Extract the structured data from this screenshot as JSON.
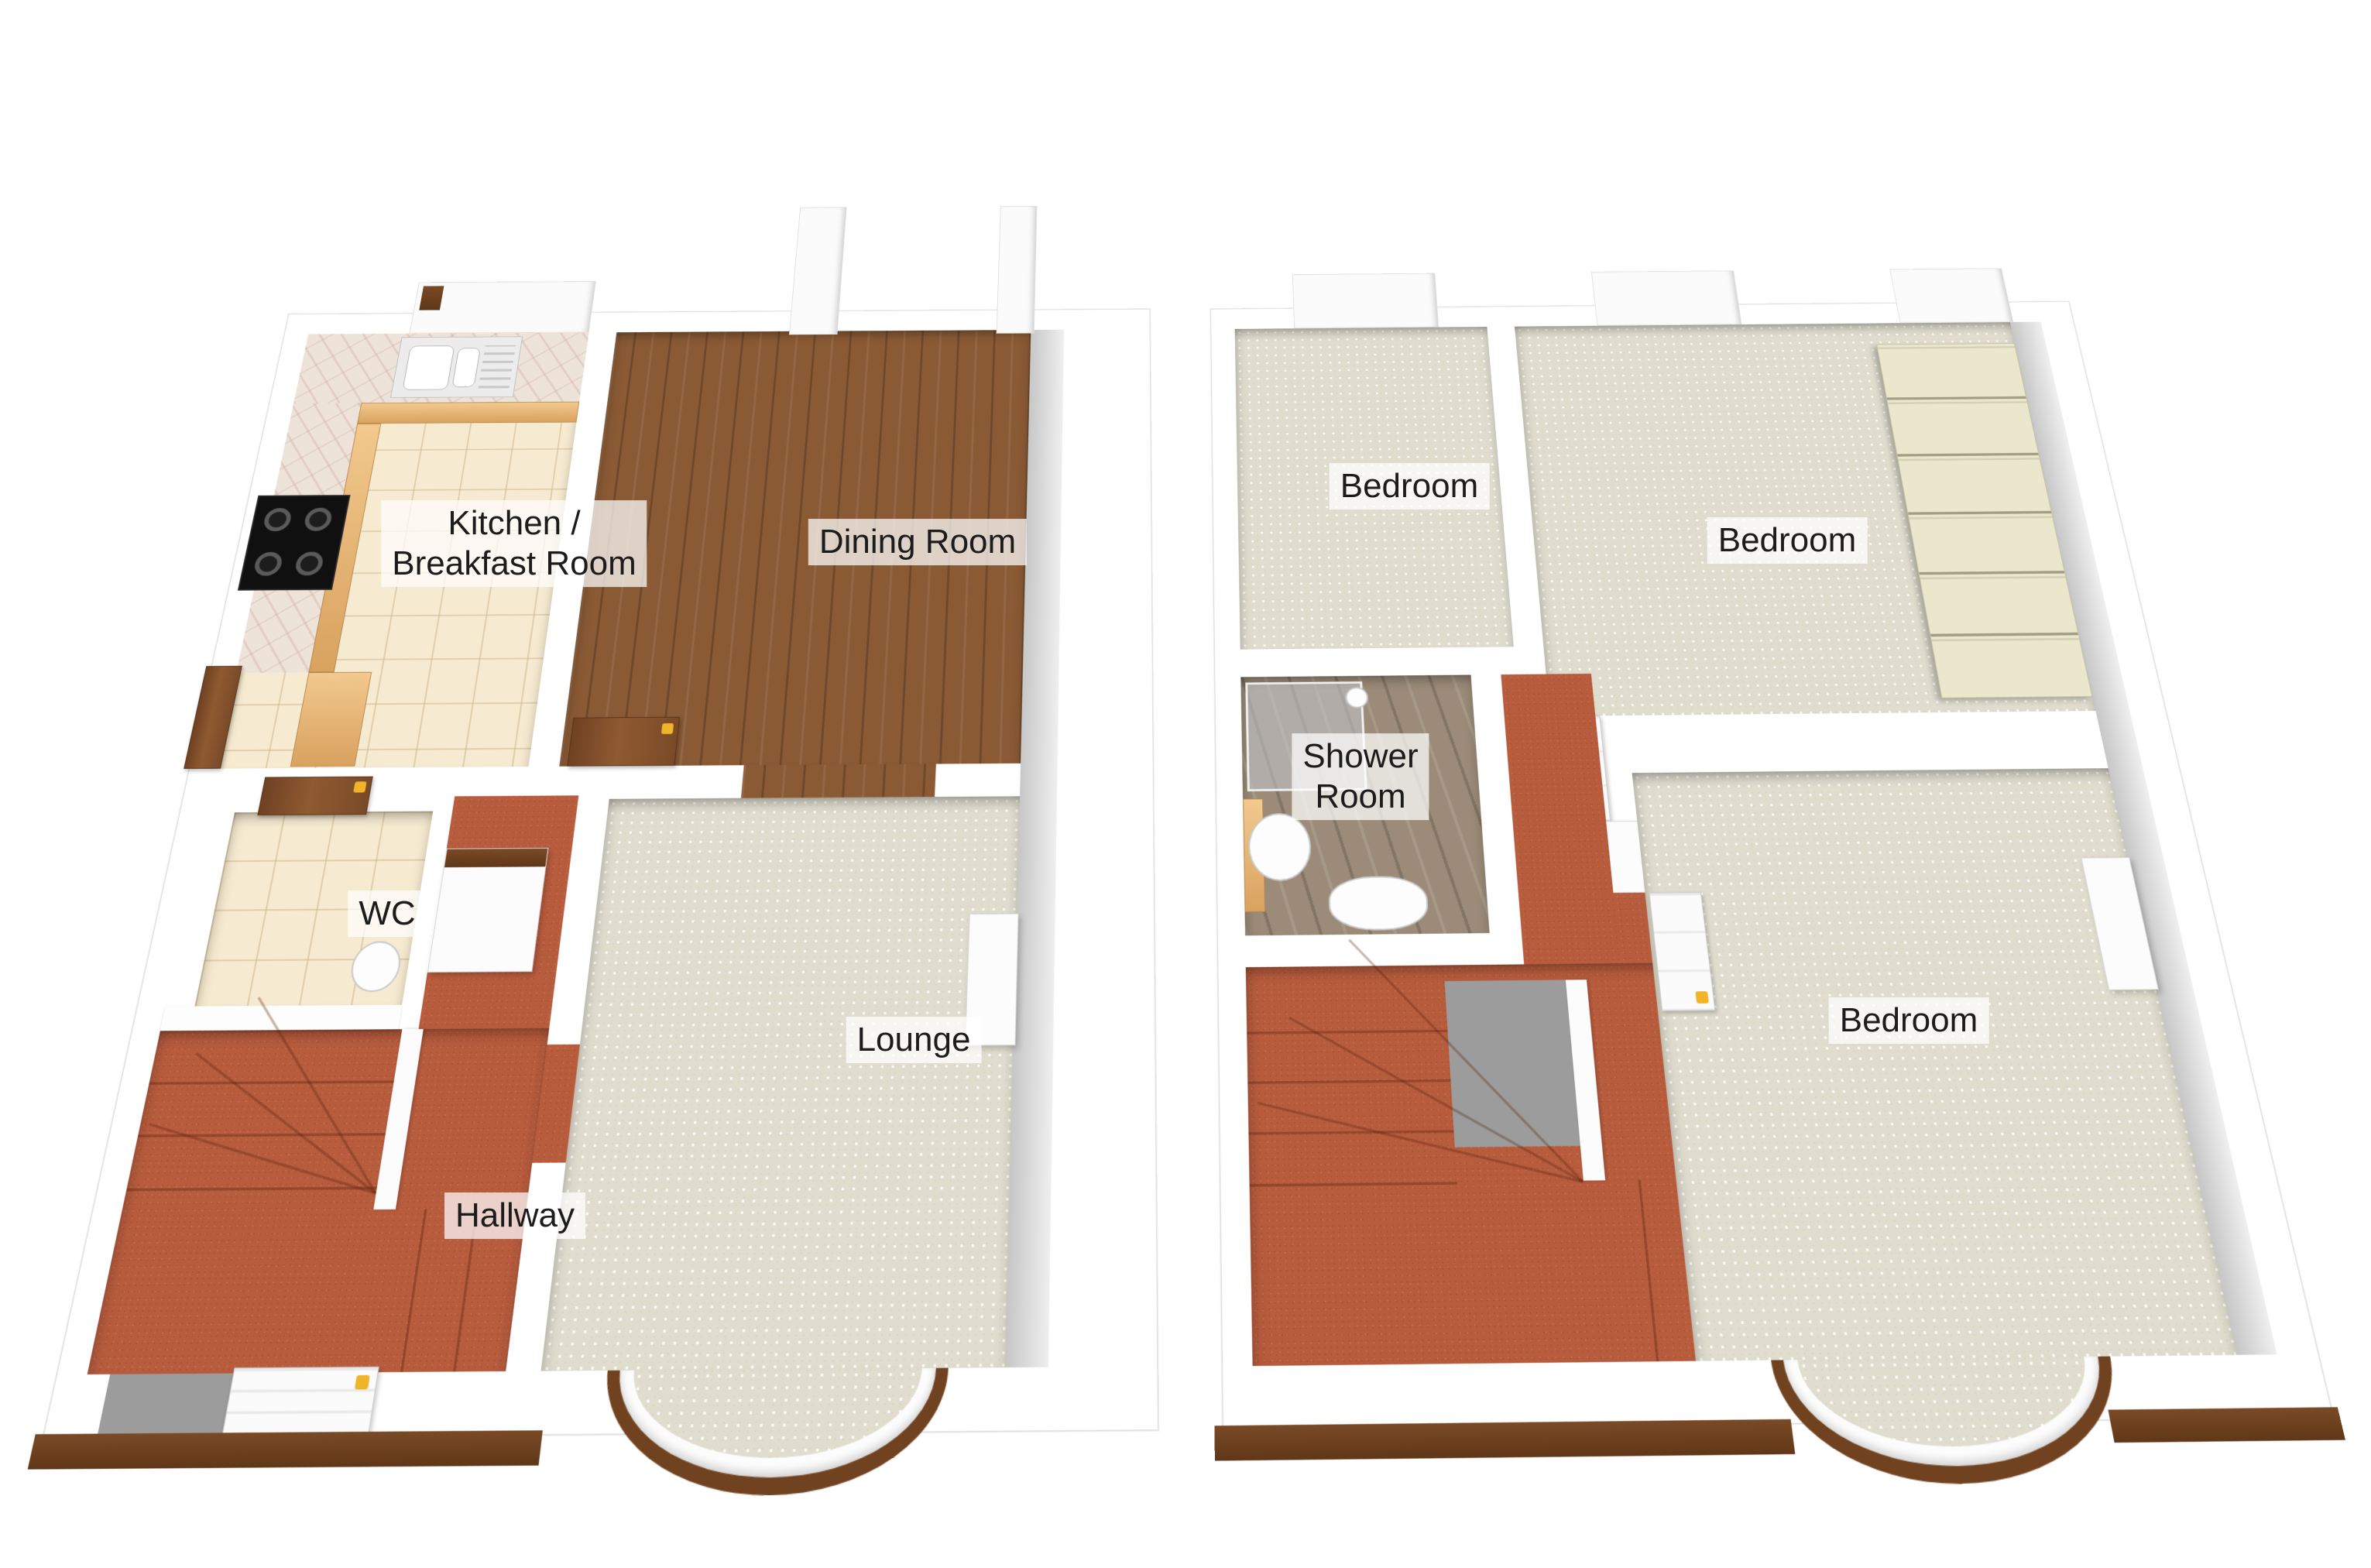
{
  "colors": {
    "wall_white": "#ffffff",
    "wall_shade": "#c7c7c7",
    "carpet_beige": "#e0ddcf",
    "carpet_red": "#b85c3e",
    "wood_dark": "#8a5a35",
    "wood_gray": "#9b8b78",
    "tile_cream": "#f6ead0",
    "worktop_marble": "#eee3d9",
    "cabinet_oak": "#e0ac66",
    "wardrobe_cream": "#eae7cd",
    "door_brown": "#7a4a28",
    "handle_yellow": "#f0b429",
    "label_text": "#1c1c1c"
  },
  "ground_floor": {
    "name": "Ground floor plan",
    "rooms": [
      {
        "id": "kitchen",
        "label": "Kitchen / Breakfast Room",
        "label_line1": "Kitchen /",
        "label_line2": "Breakfast Room",
        "floor": "cream tiles"
      },
      {
        "id": "dining-room",
        "label": "Dining Room",
        "floor": "dark wood"
      },
      {
        "id": "wc",
        "label": "WC",
        "floor": "cream tiles"
      },
      {
        "id": "hallway",
        "label": "Hallway",
        "floor": "red carpet"
      },
      {
        "id": "lounge",
        "label": "Lounge",
        "floor": "beige carpet"
      }
    ],
    "features": [
      "kitchen-sink",
      "hob",
      "kitchen-units",
      "worktop",
      "back-door",
      "understairs-cupboard",
      "staircase",
      "front-door",
      "bay-window",
      "chimney-breast"
    ]
  },
  "first_floor": {
    "name": "First floor plan",
    "rooms": [
      {
        "id": "bedroom-1",
        "label": "Bedroom",
        "floor": "beige carpet"
      },
      {
        "id": "bedroom-2",
        "label": "Bedroom",
        "floor": "beige carpet"
      },
      {
        "id": "shower-room",
        "label": "Shower Room",
        "label_line1": "Shower",
        "label_line2": "Room",
        "floor": "gray wood"
      },
      {
        "id": "bedroom-3",
        "label": "Bedroom",
        "floor": "beige carpet"
      }
    ],
    "features": [
      "fitted-wardrobes",
      "shower-cubicle",
      "wash-basin",
      "toilet",
      "staircase",
      "landing",
      "bay-window",
      "chimney-breast"
    ]
  }
}
